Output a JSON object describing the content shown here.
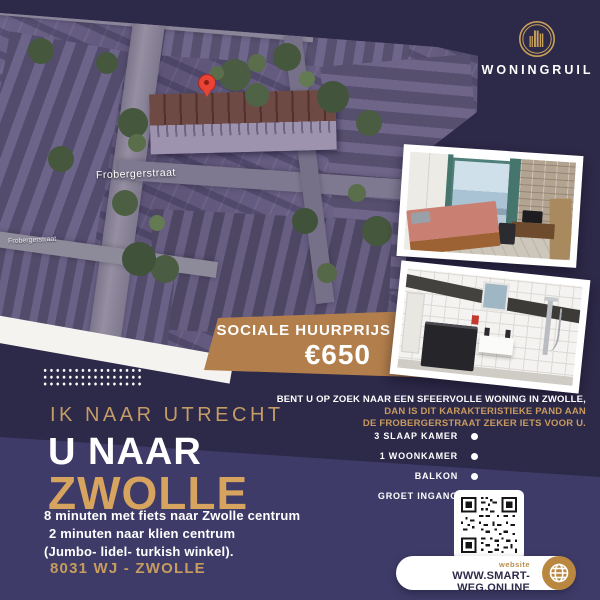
{
  "brand": {
    "name": "WONINGRUIL",
    "logo_icon": "buildings-in-gold-ring"
  },
  "map": {
    "street_label_main": "Frobergerstraat",
    "street_label_small": "Frobergerstraat",
    "pin_icon": "red-location-pin"
  },
  "price_banner": {
    "label": "SOCIALE HUURPRIJS",
    "price": "€650"
  },
  "headline": {
    "from": "IK NAAR UTRECHT",
    "to_prefix": "U NAAR",
    "to_city": "ZWOLLE"
  },
  "details": {
    "lines": [
      "8 minuten met fiets naar Zwolle centrum",
      "2 minuten naar klien centrum",
      "(Jumbo- lidel- turkish winkel)."
    ],
    "postcode": "8031 WJ - ZWOLLE"
  },
  "pitch": {
    "line1": "BENT U OP ZOEK NAAR EEN SFEERVOLLE WONING  IN ZWOLLE,",
    "line2": "DAN IS DIT KARAKTERISTIEKE PAND AAN",
    "line3": "DE FROBERGERSTRAAT ZEKER IETS VOOR U."
  },
  "features": [
    "3 SLAAP KAMER",
    "1 WOONKAMER",
    "BALKON",
    "GROET INGANG"
  ],
  "website": {
    "label": "website",
    "url": "WWW.SMART-WEG.ONLINE",
    "qr_icon": "qr-code",
    "globe_icon": "globe"
  },
  "colors": {
    "background": "#2d2948",
    "panel": "#3f3b68",
    "banner_gold": "#b27e4c",
    "headline_gold": "#d7a45f",
    "text_gold": "#c89a5f",
    "logo_gold": "#c9a158",
    "pin_red": "#ea4335"
  }
}
